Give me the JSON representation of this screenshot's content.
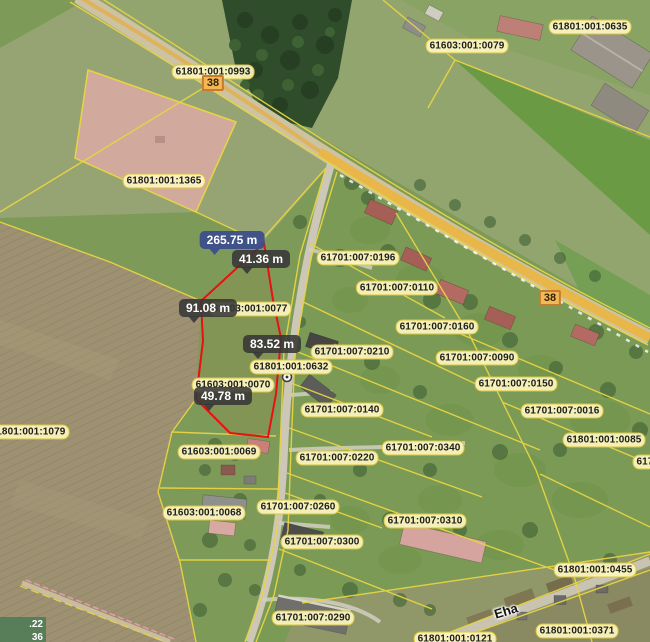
{
  "map": {
    "width": 650,
    "height": 642,
    "colors": {
      "parcel_boundary": "#e8d443",
      "selected_parcel": "#e81010",
      "cadastral_label_bg": "#fdf6bf",
      "cadastral_label_border": "#d8c23a",
      "measurement_bg": "#373737",
      "measurement_selected_bg": "#3d4f8c",
      "road_badge_bg": "#f2b857",
      "road_badge_border": "#c97a2a",
      "main_road_fill": "#e9b64a",
      "highlight_area_fill": "#d9aba3",
      "coordinate_box_bg": "#4e7a55"
    },
    "cadastral_labels": [
      {
        "text": "61801:001:0993",
        "x": 213,
        "y": 72
      },
      {
        "text": "61603:001:0079",
        "x": 467,
        "y": 46
      },
      {
        "text": "61801:001:0635",
        "x": 590,
        "y": 27
      },
      {
        "text": "61801:001:1365",
        "x": 164,
        "y": 181
      },
      {
        "text": "61701:007:0196",
        "x": 358,
        "y": 258
      },
      {
        "text": "61701:007:0110",
        "x": 397,
        "y": 288
      },
      {
        "text": "61603:001:0077",
        "x": 250,
        "y": 309
      },
      {
        "text": "61701:007:0160",
        "x": 437,
        "y": 327
      },
      {
        "text": "61701:007:0210",
        "x": 352,
        "y": 352
      },
      {
        "text": "61801:001:0632",
        "x": 291,
        "y": 367
      },
      {
        "text": "61701:007:0090",
        "x": 477,
        "y": 358
      },
      {
        "text": "61603:001:0070",
        "x": 233,
        "y": 385
      },
      {
        "text": "61701:007:0150",
        "x": 516,
        "y": 384
      },
      {
        "text": "61701:007:0140",
        "x": 342,
        "y": 410
      },
      {
        "text": "61701:007:0016",
        "x": 562,
        "y": 411
      },
      {
        "text": "61801:001:1079",
        "x": 28,
        "y": 432
      },
      {
        "text": "61801:001:0085",
        "x": 604,
        "y": 440
      },
      {
        "text": "61701:00",
        "x": 658,
        "y": 462
      },
      {
        "text": "61603:001:0069",
        "x": 219,
        "y": 452
      },
      {
        "text": "61701:007:0220",
        "x": 337,
        "y": 458
      },
      {
        "text": "61701:007:0340",
        "x": 423,
        "y": 448
      },
      {
        "text": "61603:001:0068",
        "x": 204,
        "y": 513
      },
      {
        "text": "61701:007:0260",
        "x": 298,
        "y": 507
      },
      {
        "text": "61701:007:0310",
        "x": 425,
        "y": 521
      },
      {
        "text": "61701:007:0300",
        "x": 322,
        "y": 542
      },
      {
        "text": "61801:001:0455",
        "x": 595,
        "y": 570
      },
      {
        "text": "61701:007:0290",
        "x": 313,
        "y": 618
      },
      {
        "text": "61801:001:0121",
        "x": 455,
        "y": 639
      },
      {
        "text": "61801:001:0371",
        "x": 577,
        "y": 631
      }
    ],
    "measurement_labels": [
      {
        "text": "265.75 m",
        "x": 232,
        "y": 240,
        "selected": true
      },
      {
        "text": "41.36 m",
        "x": 261,
        "y": 259,
        "selected": false
      },
      {
        "text": "91.08 m",
        "x": 208,
        "y": 308,
        "selected": false
      },
      {
        "text": "83.52 m",
        "x": 272,
        "y": 344,
        "selected": false
      },
      {
        "text": "49.78 m",
        "x": 223,
        "y": 396,
        "selected": false
      }
    ],
    "road_badges": [
      {
        "text": "38",
        "x": 213,
        "y": 83
      },
      {
        "text": "38",
        "x": 550,
        "y": 298
      }
    ],
    "street_labels": [
      {
        "text": "Eha",
        "x": 506,
        "y": 611,
        "angle": -17
      }
    ],
    "coordinate_overlay": {
      "line1": ".22",
      "line2": "36"
    }
  }
}
